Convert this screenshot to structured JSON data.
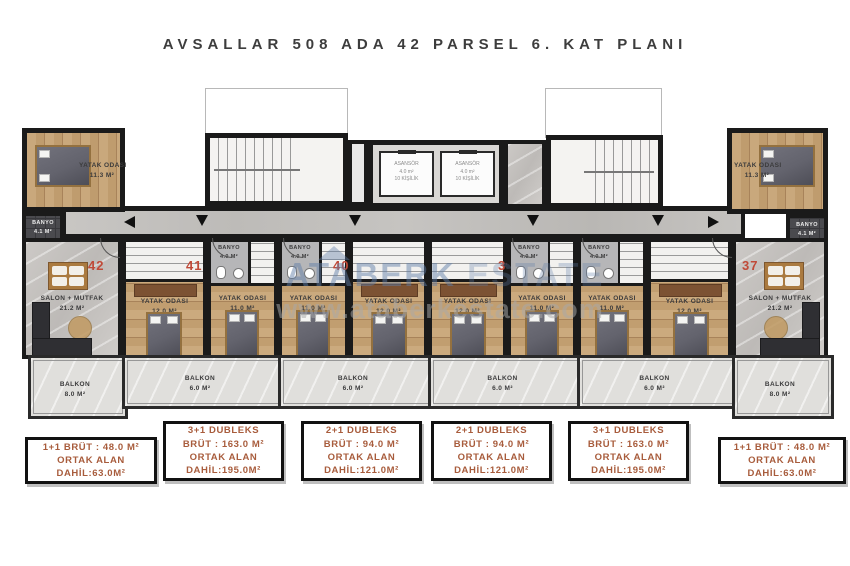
{
  "title": "AVSALLAR 508 ADA 42 PARSEL 6. KAT PLANI",
  "watermark": {
    "brand_a": "ATABERK",
    "brand_b": "ESTATE",
    "url": "www.ataberkestate.com"
  },
  "plan": {
    "unit_numbers": {
      "u42": "42",
      "u41": "41",
      "u40": "40",
      "u39": "39",
      "u38": "38",
      "u37": "37"
    },
    "corner_bedroom": {
      "name": "YATAK ODASI",
      "area": "11.3 M²"
    },
    "corner_bath": {
      "name": "BANYO",
      "area": "4.1 M²"
    },
    "salon": {
      "name": "SALON + MUTFAK",
      "area": "21.2 M²"
    },
    "bedroom_12": {
      "name": "YATAK ODASI",
      "area": "12.0 M²"
    },
    "bedroom_11": {
      "name": "YATAK ODASI",
      "area": "11.0 M²"
    },
    "bath_small": {
      "name": "BANYO",
      "area": "4.0 M²"
    },
    "balcony_large": {
      "name": "BALKON",
      "area": "8.0 M²"
    },
    "balcony_small": {
      "name": "BALKON",
      "area": "6.0 M²"
    },
    "elevator": {
      "line1": "ASANSÖR",
      "line2": "4.0 m²",
      "line3": "10 KİŞİLİK"
    }
  },
  "info_boxes": [
    {
      "lines": [
        "1+1 BRÜT : 48.0 M²",
        "ORTAK ALAN",
        "DAHİL:63.0M²"
      ]
    },
    {
      "lines": [
        "3+1 DUBLEKS",
        "BRÜT : 163.0 M²",
        "ORTAK ALAN",
        "DAHİL:195.0M²"
      ]
    },
    {
      "lines": [
        "2+1 DUBLEKS",
        "BRÜT : 94.0 M²",
        "ORTAK ALAN",
        "DAHİL:121.0M²"
      ]
    },
    {
      "lines": [
        "2+1 DUBLEKS",
        "BRÜT : 94.0 M²",
        "ORTAK ALAN",
        "DAHİL:121.0M²"
      ]
    },
    {
      "lines": [
        "3+1 DUBLEKS",
        "BRÜT : 163.0 M²",
        "ORTAK ALAN",
        "DAHİL:195.0M²"
      ]
    },
    {
      "lines": [
        "1+1 BRÜT : 48.0 M²",
        "ORTAK ALAN",
        "DAHİL:63.0M²"
      ]
    }
  ],
  "colors": {
    "accent": "#c04a38",
    "info_text": "#a85c3c",
    "wall": "#1a1a1a"
  }
}
